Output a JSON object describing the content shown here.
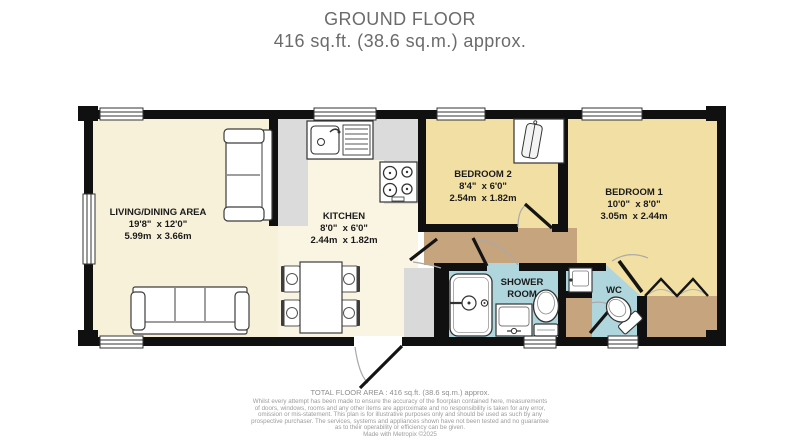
{
  "title": {
    "line1": "GROUND FLOOR",
    "line2": "416 sq.ft. (38.6 sq.m.) approx."
  },
  "rooms": {
    "living": {
      "name": "LIVING/DINING AREA",
      "imperial": "19'8\"  x 12'0\"",
      "metric": "5.99m  x 3.66m"
    },
    "kitchen": {
      "name": "KITCHEN",
      "imperial": "8'0\"  x 6'0\"",
      "metric": "2.44m  x 1.82m"
    },
    "bedroom2": {
      "name": "BEDROOM 2",
      "imperial": "8'4\"  x 6'0\"",
      "metric": "2.54m  x 1.82m"
    },
    "bedroom1": {
      "name": "BEDROOM 1",
      "imperial": "10'0\"  x 8'0\"",
      "metric": "3.05m  x 2.44m"
    },
    "shower_room": {
      "name": "SHOWER ROOM"
    },
    "wc": {
      "name": "WC"
    }
  },
  "fixtures": [
    "sofa-icon",
    "dining-table-icon",
    "chair-icon",
    "sink-drainer-icon",
    "hob-icon",
    "wardrobe-icon",
    "shower-enclosure-icon",
    "wash-basin-icon",
    "toilet-icon",
    "bifold-doors-icon",
    "window-icon",
    "door-arc-icon"
  ],
  "footer": {
    "total_area": "TOTAL FLOOR AREA : 416 sq.ft. (38.6 sq.m.) approx.",
    "disclaimer_lines": [
      "Whilst every attempt has been made to ensure the accuracy of the floorplan contained here, measurements",
      "of doors, windows, rooms and any other items are approximate and no responsibility is taken for any error,",
      "omission or mis-statement. This plan is for illustrative purposes only and should be used as such by any",
      "prospective purchaser. The services, systems and appliances shown have not been tested and no guarantee",
      "as to their operability or efficiency can be given."
    ],
    "credit": "Made with Metropix ©2025"
  },
  "colors": {
    "wall": "#101010",
    "living_floor": "#F7F1D9",
    "kitchen_floor": "#FAF5E3",
    "bedroom_floor": "#F2DFA3",
    "hall_floor": "#C6A47E",
    "bathroom_floor": "#AFD6DD",
    "counter": "#DBDBDB",
    "title_text": "#6B6B6B",
    "label_text": "#1B1B1B",
    "footer_text": "#9C9C9C"
  }
}
